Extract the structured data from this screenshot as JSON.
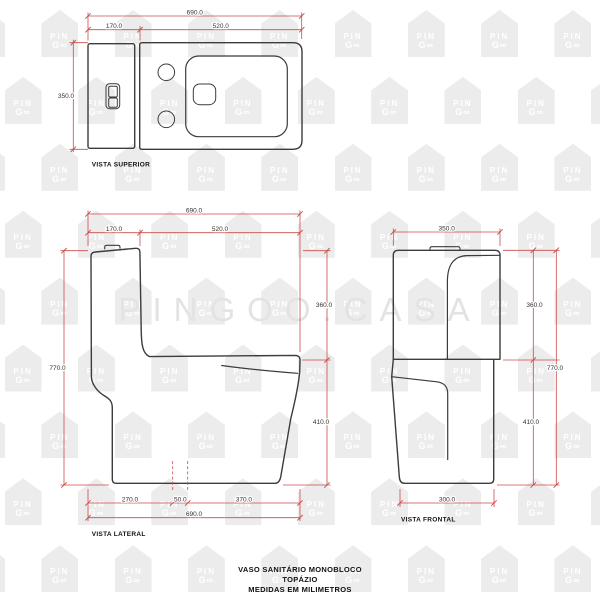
{
  "watermark": {
    "logo_line1": "PIN",
    "logo_line2": "G∞",
    "big_text": "PINGOO.CASA"
  },
  "views": {
    "top": {
      "label": "VISTA SUPERIOR",
      "dims": {
        "total_width": "690.0",
        "tank_depth": "170.0",
        "bowl_length": "520.0",
        "width": "350.0"
      }
    },
    "side": {
      "label": "VISTA LATERAL",
      "dims": {
        "total_length": "690.0",
        "tank_depth": "170.0",
        "bowl_length": "520.0",
        "total_height": "770.0",
        "tank_height": "360.0",
        "bowl_height": "410.0",
        "base_front": "270.0",
        "drain_offset": "50.0",
        "base_rear": "370.0",
        "bottom_total": "690.0"
      }
    },
    "front": {
      "label": "VISTA FRONTAL",
      "dims": {
        "tank_width": "350.0",
        "tank_height": "360.0",
        "bowl_height": "410.0",
        "total_height": "770.0",
        "base_width": "300.0"
      }
    }
  },
  "title": {
    "line1": "VASO SANITÁRIO MONOBLOCO",
    "line2": "TOPÁZIO",
    "line3": "MEDIDAS EM MILIMETROS"
  },
  "colors": {
    "dimension_red": "#c94b48",
    "drawing_line": "#3c3c3c",
    "watermark_gray": "#ececec"
  }
}
